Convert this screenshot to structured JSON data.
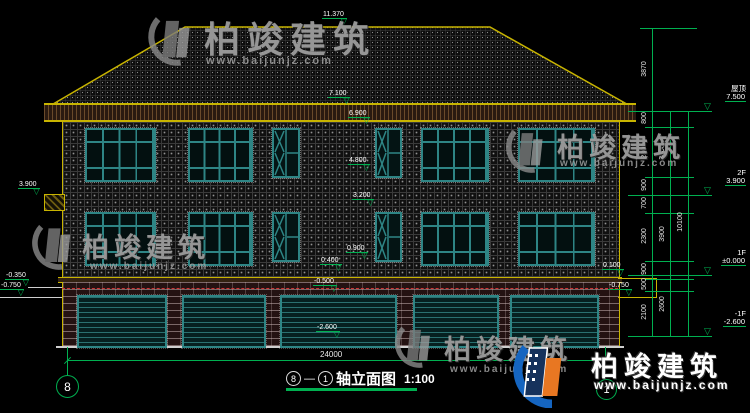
{
  "title": {
    "axis_start": "8",
    "separator": "—",
    "axis_end": "1",
    "name": "轴立面图",
    "scale": "1:100"
  },
  "grid": {
    "left_bubble": "8",
    "right_bubble": "1"
  },
  "watermark": {
    "brand": "柏竣建筑",
    "url": "www.baijunjz.com"
  },
  "levels": [
    {
      "label": "屋顶",
      "value": "7.500"
    },
    {
      "label": "2F",
      "value": "3.900"
    },
    {
      "label": "1F",
      "value": "±0.000"
    },
    {
      "label": "-1F",
      "value": "-2.600"
    }
  ],
  "dims": {
    "inner": [
      "3870",
      "800",
      "2800",
      "900",
      "700",
      "2300",
      "900",
      "500",
      "2100"
    ],
    "middle": [
      "3600",
      "3900",
      "2600"
    ],
    "outer": "10100",
    "bottom_width": "24000"
  },
  "markers": {
    "ridge": "11.370",
    "eave_top": "7.100",
    "f2_window_head": "6.900",
    "f2_window_sill": "4.800",
    "f1_window_head": "3.200",
    "f1_window_sill": "0.900",
    "plinth_top": "0.400",
    "garage_door_head": "-0.500",
    "garage_floor": "-2.600",
    "left_canopy": "3.900",
    "grade_left_upper": "-0.350",
    "grade_left_lower": "-0.750",
    "grade_right_upper": "0.100",
    "grade_right_lower": "-0.750"
  },
  "colors": {
    "dimension_green": "#00b050",
    "outline_yellow": "#c8b400",
    "window_teal": "#2e8585",
    "red_dashed": "#cc3333",
    "logo_blue": "#1565c0",
    "logo_navy": "#16325c",
    "logo_orange": "#e87722"
  }
}
